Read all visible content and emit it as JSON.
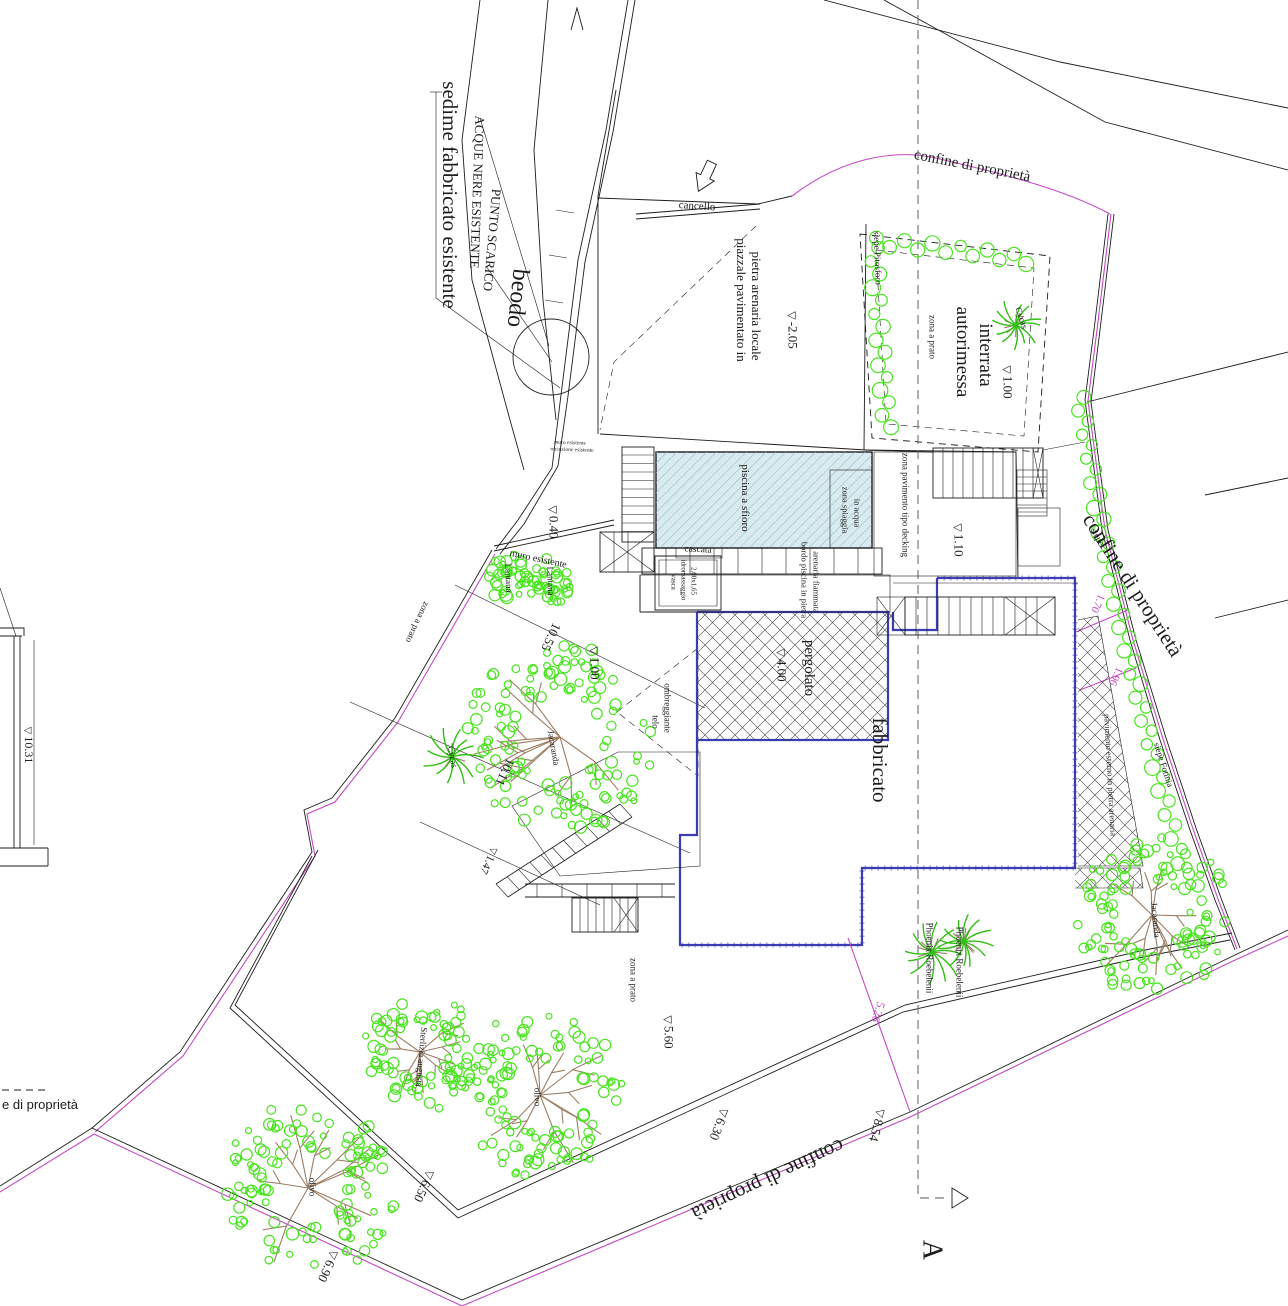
{
  "colors": {
    "line": "#1c1c1c",
    "magenta": "#c24ac2",
    "green": "#49e41f",
    "palm": "#2fbf12",
    "branch": "#9b7d63",
    "pool_fill": "#d9ebee",
    "pool_hatch": "#8fbccb",
    "blue_wall": "#3c3cb4",
    "section": "#7a7a7a"
  },
  "labels": [
    {
      "name": "label-sedime-fabbricato-esistente",
      "text": "sedime fabbricato esistente",
      "x": 450,
      "y": 195,
      "rot": 90,
      "size": 21
    },
    {
      "name": "label-acque-nere-esistente",
      "text": "ACQUE NERE ESISTENTE",
      "x": 477,
      "y": 192,
      "rot": 92,
      "size": 13
    },
    {
      "name": "label-punto-scarico",
      "text": "PUNTO SCARICO",
      "x": 492,
      "y": 240,
      "rot": 95,
      "size": 13
    },
    {
      "name": "label-beodo",
      "text": "beodo",
      "x": 517,
      "y": 298,
      "rot": 96,
      "size": 24
    },
    {
      "name": "label-cancello",
      "text": "cancello",
      "x": 697,
      "y": 207,
      "rot": 4,
      "size": 11
    },
    {
      "name": "label-piazzale-line1",
      "text": "piazzale pavimentato in",
      "x": 741,
      "y": 300,
      "rot": 90,
      "size": 13
    },
    {
      "name": "label-piazzale-line2",
      "text": "pietra arenaria locale",
      "x": 756,
      "y": 306,
      "rot": 90,
      "size": 13
    },
    {
      "name": "dim-minus-2-05",
      "text": "-2.05",
      "x": 792,
      "y": 330,
      "rot": 90,
      "size": 13,
      "tri": true
    },
    {
      "name": "label-siepe-pitosforo",
      "text": "siepe Pitosforo",
      "x": 877,
      "y": 258,
      "rot": 88,
      "size": 9
    },
    {
      "name": "label-autorimessa-line1",
      "text": "autorimessa",
      "x": 962,
      "y": 352,
      "rot": 90,
      "size": 19
    },
    {
      "name": "label-autorimessa-line2",
      "text": "interrata",
      "x": 985,
      "y": 355,
      "rot": 90,
      "size": 19
    },
    {
      "name": "label-zona-a-prato-garage",
      "text": "zona a prato",
      "x": 932,
      "y": 337,
      "rot": 90,
      "size": 9
    },
    {
      "name": "label-cycas-garage",
      "text": "Cycas",
      "x": 1021,
      "y": 318,
      "rot": 70,
      "size": 9
    },
    {
      "name": "dim-1-00-garage",
      "text": "1.00",
      "x": 1007,
      "y": 382,
      "rot": 90,
      "size": 13,
      "tri": true
    },
    {
      "name": "label-confine-di-proprieta-top",
      "text": "confine di proprietà",
      "x": 972,
      "y": 167,
      "rot": 11,
      "size": 15
    },
    {
      "name": "label-confine-di-proprieta-right",
      "text": "confine di proprietà",
      "x": 1133,
      "y": 585,
      "rot": 57,
      "size": 21
    },
    {
      "name": "label-siepe-small",
      "text": "siepe",
      "x": 1097,
      "y": 537,
      "rot": 62,
      "size": 9
    },
    {
      "name": "label-siepe-fotinia",
      "text": "siepe Fotinia",
      "x": 1163,
      "y": 765,
      "rot": 72,
      "size": 9
    },
    {
      "name": "label-muro-esistente",
      "text": "muro esistente",
      "x": 538,
      "y": 560,
      "rot": 12,
      "size": 10
    },
    {
      "name": "label-tiny-line1",
      "text": "muro esistente",
      "x": 570,
      "y": 444,
      "rot": 2,
      "size": 5.5
    },
    {
      "name": "label-tiny-line2",
      "text": "recinzione esistente",
      "x": 572,
      "y": 451,
      "rot": 2,
      "size": 5.5
    },
    {
      "name": "label-piscina-a-sfioro",
      "text": "piscina a sfioro",
      "x": 744,
      "y": 498,
      "rot": 90,
      "size": 11
    },
    {
      "name": "label-zona-spiaggia-line1",
      "text": "zona spiaggia",
      "x": 845,
      "y": 510,
      "rot": 90,
      "size": 8.5
    },
    {
      "name": "label-zona-spiaggia-line2",
      "text": "in acqua",
      "x": 857,
      "y": 513,
      "rot": 90,
      "size": 8.5
    },
    {
      "name": "label-cascata",
      "text": "cascata",
      "x": 698,
      "y": 551,
      "rot": 3,
      "size": 9.5
    },
    {
      "name": "label-vasca-line1",
      "text": "vasca",
      "x": 673,
      "y": 582,
      "rot": 90,
      "size": 7
    },
    {
      "name": "label-vasca-line2",
      "text": "idromassaggio",
      "x": 683,
      "y": 580,
      "rot": 90,
      "size": 7
    },
    {
      "name": "label-vasca-line3",
      "text": "2,00x1,65",
      "x": 693,
      "y": 581,
      "rot": 90,
      "size": 7
    },
    {
      "name": "label-zona-pavimento-decking",
      "text": "zona pavimento tipo decking",
      "x": 905,
      "y": 505,
      "rot": 90,
      "size": 9
    },
    {
      "name": "dim-1-10",
      "text": "1.10",
      "x": 958,
      "y": 540,
      "rot": 90,
      "size": 13,
      "tri": true
    },
    {
      "name": "label-bordo-piscina-line1",
      "text": "bordo piscina in pietra",
      "x": 804,
      "y": 580,
      "rot": 90,
      "size": 8.5
    },
    {
      "name": "label-bordo-piscina-line2",
      "text": "arenaria fiammata",
      "x": 816,
      "y": 582,
      "rot": 90,
      "size": 8.5
    },
    {
      "name": "label-pergolato",
      "text": "pergolato",
      "x": 808,
      "y": 668,
      "rot": 90,
      "size": 15
    },
    {
      "name": "dim-4-00",
      "text": "4.00",
      "x": 781,
      "y": 665,
      "rot": 90,
      "size": 13,
      "tri": true
    },
    {
      "name": "label-fabbricato",
      "text": "fabbricato",
      "x": 880,
      "y": 760,
      "rot": 90,
      "size": 21
    },
    {
      "name": "label-pavimento-esterno",
      "text": "pavimento esterno in pietra arenaria",
      "x": 1110,
      "y": 775,
      "rot": 87,
      "size": 8.5
    },
    {
      "name": "dim-1-70",
      "text": "1.70",
      "x": 1097,
      "y": 603,
      "rot": 115,
      "size": 11,
      "c": "mag"
    },
    {
      "name": "dim-1-96",
      "text": "1.96",
      "x": 1115,
      "y": 676,
      "rot": 115,
      "size": 11,
      "c": "mag"
    },
    {
      "name": "label-zona-a-prato-left",
      "text": "zona a prato",
      "x": 417,
      "y": 622,
      "rot": 115,
      "size": 9
    },
    {
      "name": "dim-10-55",
      "text": "10.55",
      "x": 551,
      "y": 637,
      "rot": 115,
      "size": 13
    },
    {
      "name": "dim-1-00-center",
      "text": "1.00",
      "x": 594,
      "y": 663,
      "rot": 90,
      "size": 13,
      "tri": true
    },
    {
      "name": "label-jacaranda-center",
      "text": "Jacaranda",
      "x": 553,
      "y": 748,
      "rot": 80,
      "size": 9
    },
    {
      "name": "label-lantana-1",
      "text": "Lantana",
      "x": 508,
      "y": 578,
      "rot": 88,
      "size": 9
    },
    {
      "name": "label-lantana-2",
      "text": "Lantana",
      "x": 550,
      "y": 581,
      "rot": 88,
      "size": 9
    },
    {
      "name": "label-cycas-left",
      "text": "Cycas",
      "x": 452,
      "y": 757,
      "rot": 80,
      "size": 9
    },
    {
      "name": "label-telo-line1",
      "text": "telo",
      "x": 655,
      "y": 722,
      "rot": 90,
      "size": 9
    },
    {
      "name": "label-telo-line2",
      "text": "ombreggiante",
      "x": 667,
      "y": 708,
      "rot": 90,
      "size": 9
    },
    {
      "name": "dim-10-11",
      "text": "10.11",
      "x": 505,
      "y": 772,
      "rot": 115,
      "size": 13
    },
    {
      "name": "dim-1-47",
      "text": "1.47",
      "x": 488,
      "y": 860,
      "rot": 115,
      "size": 11,
      "tri": true
    },
    {
      "name": "dim-0-40",
      "text": "0.40",
      "x": 553,
      "y": 522,
      "rot": 90,
      "size": 13,
      "tri": true
    },
    {
      "name": "dim-10-31",
      "text": "10.31",
      "x": 28,
      "y": 745,
      "rot": 90,
      "size": 12,
      "tri": true
    },
    {
      "name": "legend-confine-di-proprieta",
      "text": "e di proprietà",
      "x": 40,
      "y": 1105,
      "rot": 0,
      "size": 13,
      "f": "sans"
    },
    {
      "name": "label-zona-a-prato-bottom",
      "text": "zona a prato",
      "x": 633,
      "y": 980,
      "rot": 90,
      "size": 9
    },
    {
      "name": "dim-5-60",
      "text": "5.60",
      "x": 668,
      "y": 1032,
      "rot": 90,
      "size": 13,
      "tri": true
    },
    {
      "name": "dim-6-30",
      "text": "6.30",
      "x": 719,
      "y": 1124,
      "rot": 112,
      "size": 13,
      "tri": true
    },
    {
      "name": "label-confine-di-proprieta-bottom",
      "text": "confine di proprietà",
      "x": 768,
      "y": 1180,
      "rot": 155,
      "size": 21
    },
    {
      "name": "dim-8-54",
      "text": "8.54",
      "x": 877,
      "y": 1125,
      "rot": 105,
      "size": 13,
      "tri": true
    },
    {
      "name": "dim-5-26",
      "text": "5.26",
      "x": 878,
      "y": 1012,
      "rot": 108,
      "size": 12,
      "c": "mag"
    },
    {
      "name": "label-phoenix-roebelenii-1",
      "text": "Phoenix Roebelenii",
      "x": 929,
      "y": 958,
      "rot": 90,
      "size": 9
    },
    {
      "name": "label-phoenix-roebelenii-2",
      "text": "Phoenix Roebelenii",
      "x": 959,
      "y": 962,
      "rot": 90,
      "size": 9
    },
    {
      "name": "label-jacaranda-right",
      "text": "Jacaranda",
      "x": 1155,
      "y": 920,
      "rot": 85,
      "size": 9
    },
    {
      "name": "label-sterlizia-augusta",
      "text": "Sterlizia augusta",
      "x": 421,
      "y": 1057,
      "rot": 95,
      "size": 9
    },
    {
      "name": "label-olivo-center",
      "text": "olivo",
      "x": 537,
      "y": 1097,
      "rot": 90,
      "size": 9
    },
    {
      "name": "label-olivo-bottom-left",
      "text": "olivo",
      "x": 312,
      "y": 1187,
      "rot": 90,
      "size": 9
    },
    {
      "name": "dim-6-50",
      "text": "6.50",
      "x": 424,
      "y": 1186,
      "rot": 115,
      "size": 13,
      "tri": true
    },
    {
      "name": "dim-6-90",
      "text": "6.90",
      "x": 328,
      "y": 1266,
      "rot": 115,
      "size": 13,
      "tri": true
    },
    {
      "name": "section-label-a",
      "text": "A",
      "x": 932,
      "y": 1250,
      "rot": 90,
      "size": 28
    }
  ]
}
